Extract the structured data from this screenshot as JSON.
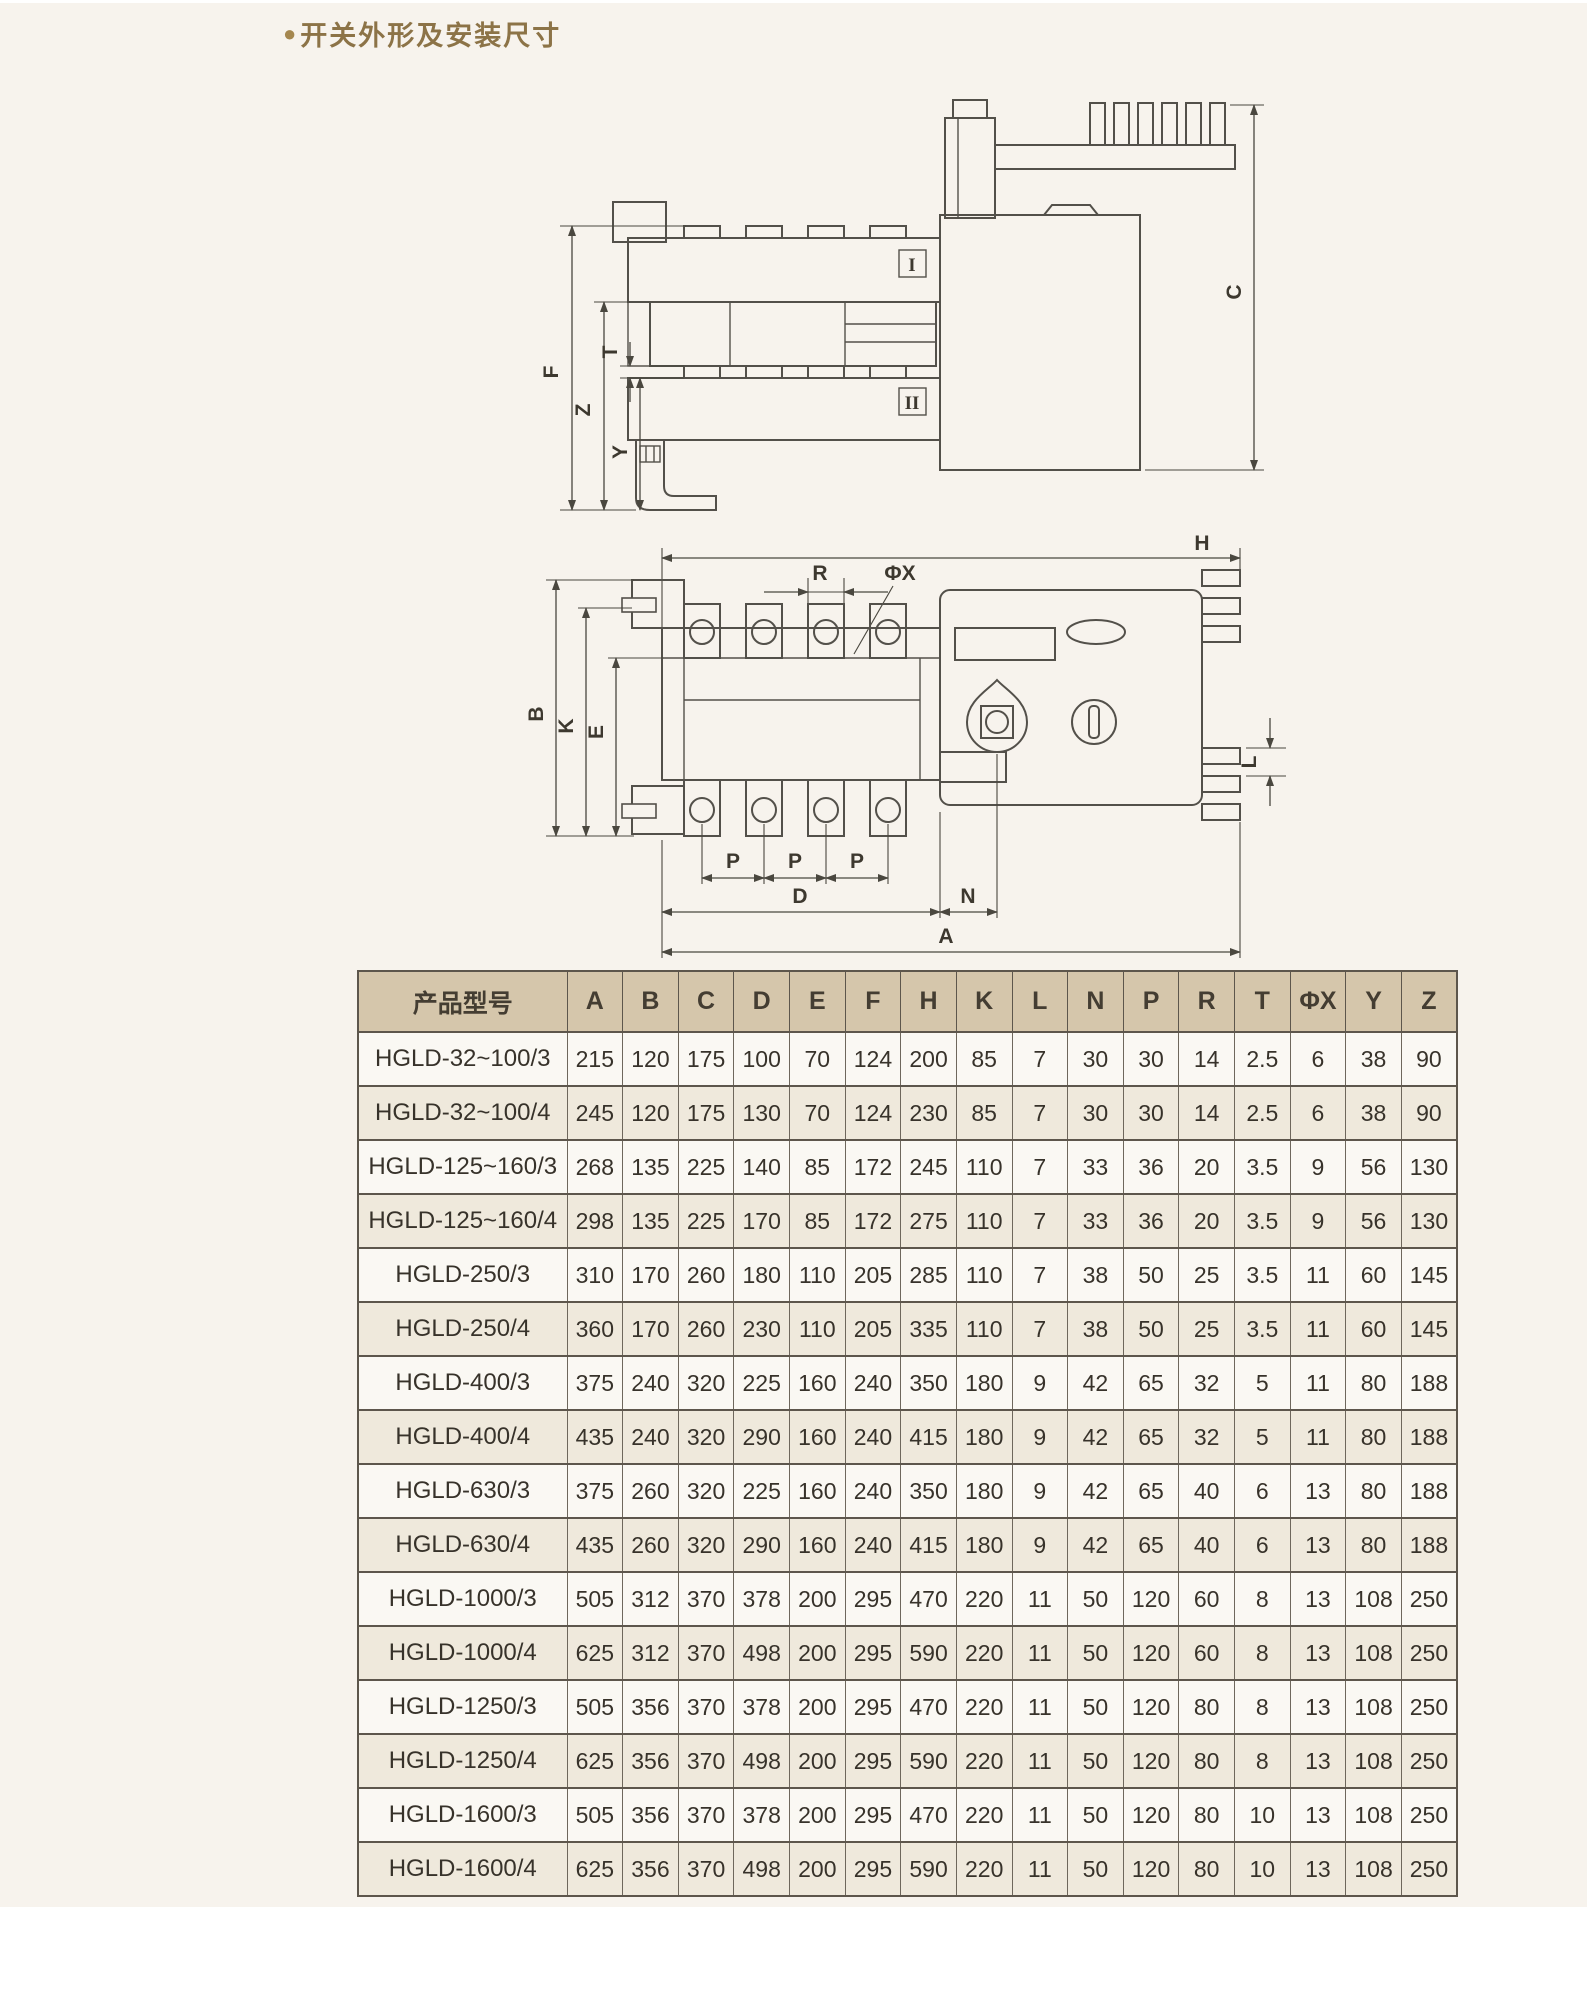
{
  "header": {
    "bullet": "●",
    "title": "开关外形及安装尺寸"
  },
  "diagrams": {
    "side_view": {
      "labels": {
        "F": "F",
        "Z": "Z",
        "T": "T",
        "Y": "Y",
        "C": "C",
        "pole_I": "I",
        "pole_II": "II"
      }
    },
    "top_view": {
      "labels": {
        "H": "H",
        "R": "R",
        "PhiX": "ΦX",
        "B": "B",
        "K": "K",
        "E": "E",
        "L": "L",
        "P": "P",
        "D": "D",
        "N": "N",
        "A": "A"
      }
    }
  },
  "table": {
    "headers": [
      "产品型号",
      "A",
      "B",
      "C",
      "D",
      "E",
      "F",
      "H",
      "K",
      "L",
      "N",
      "P",
      "R",
      "T",
      "ΦX",
      "Y",
      "Z"
    ],
    "rows": [
      {
        "model": "HGLD-32~100/3",
        "values": [
          "215",
          "120",
          "175",
          "100",
          "70",
          "124",
          "200",
          "85",
          "7",
          "30",
          "30",
          "14",
          "2.5",
          "6",
          "38",
          "90"
        ]
      },
      {
        "model": "HGLD-32~100/4",
        "values": [
          "245",
          "120",
          "175",
          "130",
          "70",
          "124",
          "230",
          "85",
          "7",
          "30",
          "30",
          "14",
          "2.5",
          "6",
          "38",
          "90"
        ]
      },
      {
        "model": "HGLD-125~160/3",
        "values": [
          "268",
          "135",
          "225",
          "140",
          "85",
          "172",
          "245",
          "110",
          "7",
          "33",
          "36",
          "20",
          "3.5",
          "9",
          "56",
          "130"
        ]
      },
      {
        "model": "HGLD-125~160/4",
        "values": [
          "298",
          "135",
          "225",
          "170",
          "85",
          "172",
          "275",
          "110",
          "7",
          "33",
          "36",
          "20",
          "3.5",
          "9",
          "56",
          "130"
        ]
      },
      {
        "model": "HGLD-250/3",
        "values": [
          "310",
          "170",
          "260",
          "180",
          "110",
          "205",
          "285",
          "110",
          "7",
          "38",
          "50",
          "25",
          "3.5",
          "11",
          "60",
          "145"
        ]
      },
      {
        "model": "HGLD-250/4",
        "values": [
          "360",
          "170",
          "260",
          "230",
          "110",
          "205",
          "335",
          "110",
          "7",
          "38",
          "50",
          "25",
          "3.5",
          "11",
          "60",
          "145"
        ]
      },
      {
        "model": "HGLD-400/3",
        "values": [
          "375",
          "240",
          "320",
          "225",
          "160",
          "240",
          "350",
          "180",
          "9",
          "42",
          "65",
          "32",
          "5",
          "11",
          "80",
          "188"
        ]
      },
      {
        "model": "HGLD-400/4",
        "values": [
          "435",
          "240",
          "320",
          "290",
          "160",
          "240",
          "415",
          "180",
          "9",
          "42",
          "65",
          "32",
          "5",
          "11",
          "80",
          "188"
        ]
      },
      {
        "model": "HGLD-630/3",
        "values": [
          "375",
          "260",
          "320",
          "225",
          "160",
          "240",
          "350",
          "180",
          "9",
          "42",
          "65",
          "40",
          "6",
          "13",
          "80",
          "188"
        ]
      },
      {
        "model": "HGLD-630/4",
        "values": [
          "435",
          "260",
          "320",
          "290",
          "160",
          "240",
          "415",
          "180",
          "9",
          "42",
          "65",
          "40",
          "6",
          "13",
          "80",
          "188"
        ]
      },
      {
        "model": "HGLD-1000/3",
        "values": [
          "505",
          "312",
          "370",
          "378",
          "200",
          "295",
          "470",
          "220",
          "11",
          "50",
          "120",
          "60",
          "8",
          "13",
          "108",
          "250"
        ]
      },
      {
        "model": "HGLD-1000/4",
        "values": [
          "625",
          "312",
          "370",
          "498",
          "200",
          "295",
          "590",
          "220",
          "11",
          "50",
          "120",
          "60",
          "8",
          "13",
          "108",
          "250"
        ]
      },
      {
        "model": "HGLD-1250/3",
        "values": [
          "505",
          "356",
          "370",
          "378",
          "200",
          "295",
          "470",
          "220",
          "11",
          "50",
          "120",
          "80",
          "8",
          "13",
          "108",
          "250"
        ]
      },
      {
        "model": "HGLD-1250/4",
        "values": [
          "625",
          "356",
          "370",
          "498",
          "200",
          "295",
          "590",
          "220",
          "11",
          "50",
          "120",
          "80",
          "8",
          "13",
          "108",
          "250"
        ]
      },
      {
        "model": "HGLD-1600/3",
        "values": [
          "505",
          "356",
          "370",
          "378",
          "200",
          "295",
          "470",
          "220",
          "11",
          "50",
          "120",
          "80",
          "10",
          "13",
          "108",
          "250"
        ]
      },
      {
        "model": "HGLD-1600/4",
        "values": [
          "625",
          "356",
          "370",
          "498",
          "200",
          "295",
          "590",
          "220",
          "11",
          "50",
          "120",
          "80",
          "10",
          "13",
          "108",
          "250"
        ]
      }
    ]
  }
}
